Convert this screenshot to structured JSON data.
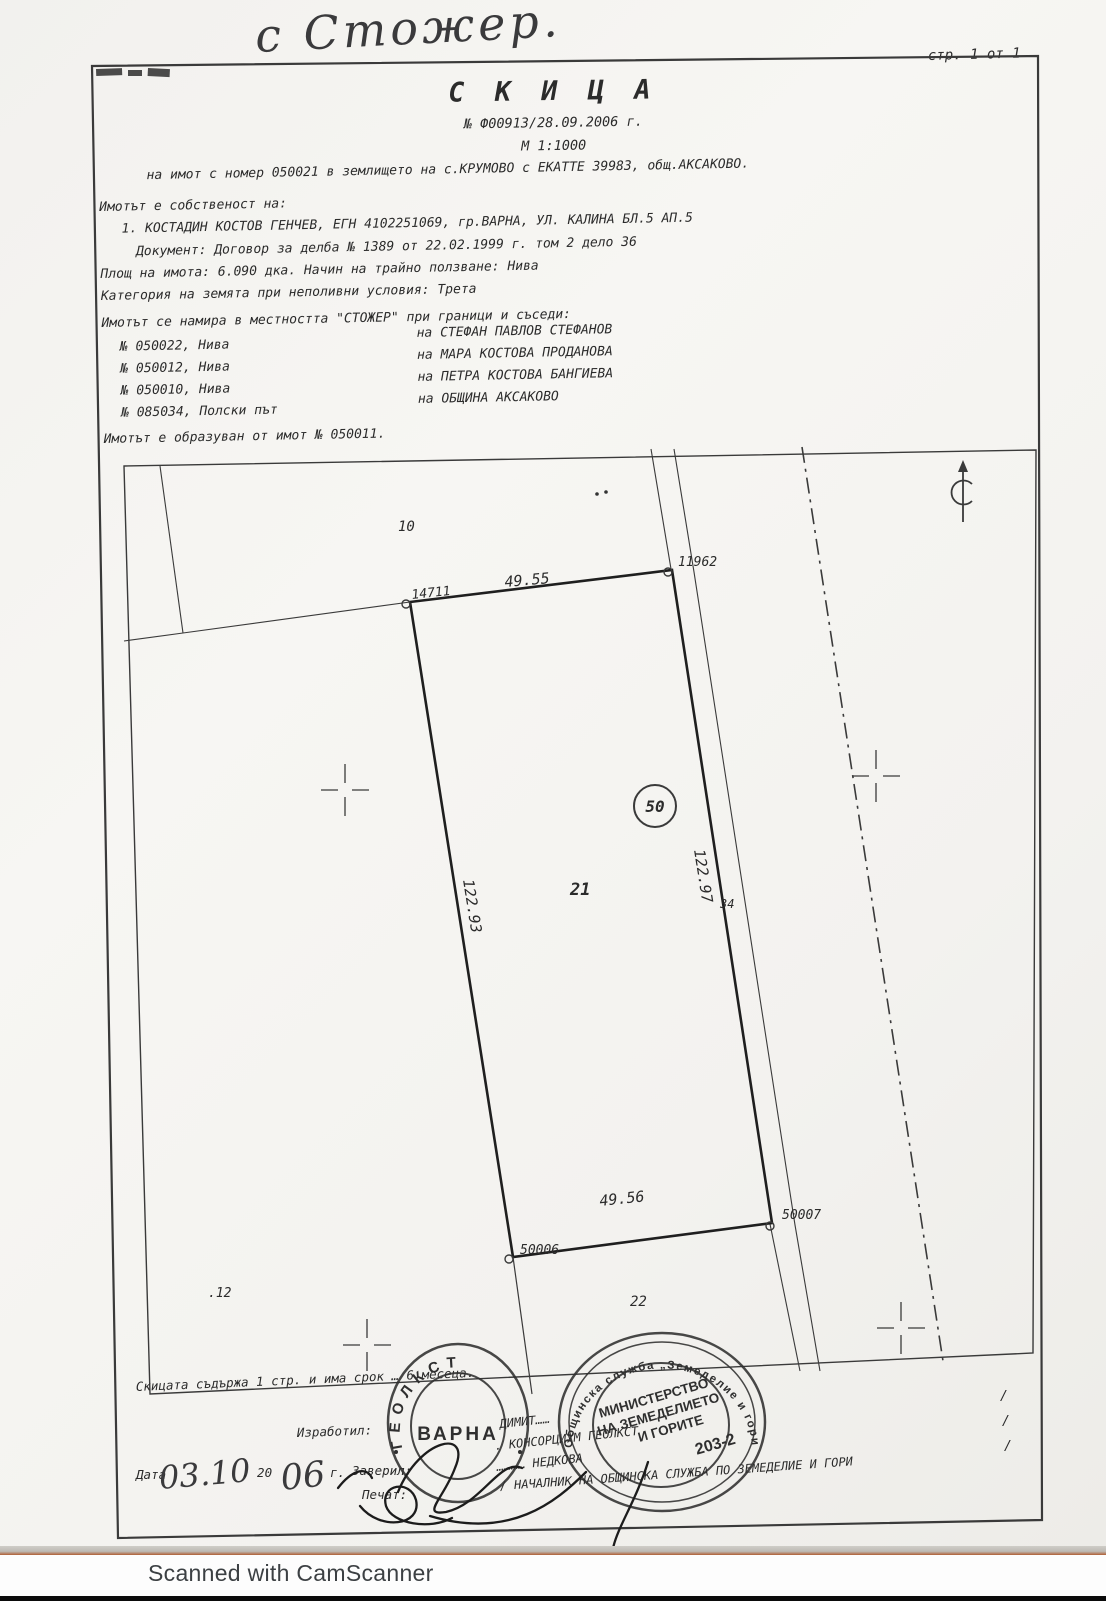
{
  "note": {
    "handwritten_village": "с Стожер."
  },
  "page": {
    "page_indicator": "стр. 1 от 1",
    "title": "С К И Ц А",
    "doc_number": "№ Ф00913/28.09.2006 г.",
    "scale": "М 1:1000",
    "subject_line": "на имот с номер 050021 в землището на с.КРУМОВО с ЕКАТТЕ 39983, общ.АКСАКОВО.",
    "ownership_heading": "Имотът е собственост на:",
    "owner_line": "1. КОСТАДИН КОСТОВ ГЕНЧЕВ, ЕГН 4102251069, гр.ВАРНА, УЛ. КАЛИНА БЛ.5 АП.5",
    "document_line": "Документ: Договор за делба № 1389 от 22.02.1999 г. том 2 дело 36",
    "area_line": "Площ на имота: 6.090 дка. Начин на трайно ползване: Нива",
    "category_line": "Категория на земята при неполивни условия: Трета",
    "location_line": "Имотът се намира в местността \"СТОЖЕР\" при граници и съседи:",
    "origin_line": "Имотът е образуван от имот № 050011."
  },
  "neighbors": [
    {
      "parcel": "№ 050022, Нива",
      "owner": "на  СТЕФАН ПАВЛОВ СТЕФАНОВ"
    },
    {
      "parcel": "№ 050012, Нива",
      "owner": "на  МАРА КОСТОВА ПРОДАНОВА"
    },
    {
      "parcel": "№ 050010, Нива",
      "owner": "на  ПЕТРА КОСТОВА БАНГИЕВА"
    },
    {
      "parcel": "№ 085034, Полски път",
      "owner": "на  ОБЩИНА АКСАКОВО"
    }
  ],
  "map": {
    "parcel_number": "21",
    "circled_number": "50",
    "adjacent_top": "10",
    "adjacent_bottom": "22",
    "adjacent_left": ".12",
    "road_label": "34",
    "dim_top": "49.55",
    "dim_bottom": "49.56",
    "dim_left": "122.93",
    "dim_right": "122.97",
    "pt_top_left": "14711",
    "pt_top_right": "11962",
    "pt_bottom_right": "50007",
    "pt_bottom_left": "50006"
  },
  "footer": {
    "validity_line": "Скицата съдържа 1 стр. и има срок … 6 месеца.",
    "prepared_label": "Изработил:",
    "date_label": "Дата",
    "date_hand_day": "03.10",
    "date_typed": ". 20",
    "date_hand_year": "06",
    "date_suffix": "г.",
    "certified_label": "Заверил:",
    "seal_label": "Печат:",
    "name_line1": "ДИМИТ……",
    "name_line2": ". КОНСОРЦИУМ ГЕОЛКСТ",
    "name_line3": "…………  НЕДКОВА",
    "chief_line": "/ НАЧАЛНИК НА ОБЩИНСКА СЛУЖБА ПО ЗЕМЕДЕЛИЕ И ГОРИ",
    "slash_mark": "/"
  },
  "stamps": {
    "round_small": {
      "ring_text": "ГЕОЛКСТ",
      "center_text": "ВАРНА"
    },
    "round_large": {
      "ring_text": "Общинска служба „Земеделие и гори\"",
      "center_line1": "МИНИСТЕРСТВО",
      "center_line2": "НА ЗЕМЕДЕЛИЕТО",
      "center_line3": "И ГОРИТЕ",
      "number": "203-2"
    }
  },
  "scanner": {
    "label": "Scanned with CamScanner"
  },
  "colors": {
    "paper": "#f4f3f0",
    "ink": "#2b2b2b",
    "scanner_text": "#3c4043",
    "scan_edge": "#b06034"
  }
}
